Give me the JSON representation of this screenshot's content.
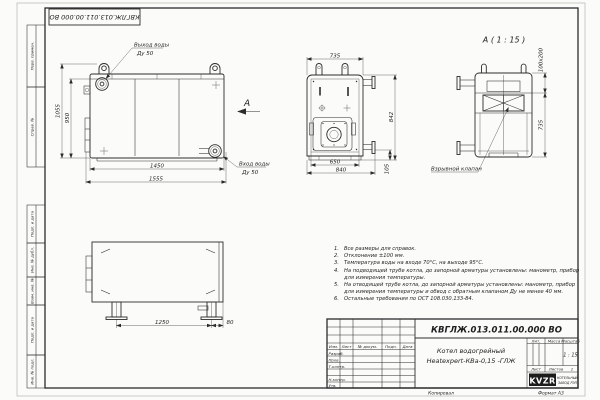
{
  "sheet": {
    "top_stamp": "КВГЛЖ.013.011.00.000 ВО",
    "margin_strips": {
      "s1": "Перв. примен.",
      "s2": "Справ. №",
      "s3": "Подп. и дата",
      "s4": "Инв. № дубл.",
      "s5": "Взам. инв. №",
      "s6": "Подп. и дата",
      "s7": "Инв. № подл."
    },
    "footer": {
      "copied": "Копировал",
      "format": "Формат А3"
    }
  },
  "side_view": {
    "outlet_label": "Выход воды",
    "outlet_dn": "Ду 50",
    "inlet_label": "Вход воды",
    "inlet_dn": "Ду 50",
    "view_letter": "А",
    "dims": {
      "height_overall": "1055",
      "height_body": "950",
      "width_inner": "1450",
      "width_overall": "1555"
    }
  },
  "front_view": {
    "dims": {
      "top_width": "735",
      "inner_width": "650",
      "overall_width": "840",
      "height": "842",
      "stub_height": "105"
    }
  },
  "detail_view": {
    "title": "А ( 1 : 15 )",
    "valve_label": "Взрывной клапан",
    "dims": {
      "slot": "100х200",
      "height": "735"
    }
  },
  "rear_view": {
    "dims": {
      "leg_span": "1250",
      "edge_offset": "80"
    }
  },
  "notes": [
    {
      "num": "1.",
      "text": "Все размеры для справок."
    },
    {
      "num": "2.",
      "text": "Отклонение ±100 мм."
    },
    {
      "num": "3.",
      "text": "Температура воды на входе 70°С, на выходе 95°С."
    },
    {
      "num": "4.",
      "text": "На подводящей трубе котла, до запорной арматуры установлены: манометр, прибор для измерения температуры."
    },
    {
      "num": "5.",
      "text": "На отводящей трубе котла, до запорной арматуры установлены: манометр, прибор для измерения температуры и обвод с обратным клапаном Ду не менее 40 мм."
    },
    {
      "num": "6.",
      "text": "Остальные требования по ОСТ 108.030.133-84."
    }
  ],
  "title_block": {
    "doc_number": "КВГЛЖ.013.011.00.000 ВО",
    "name_line1": "Котел водогрейный",
    "name_line2": "Heatexpert-КВа-0,15 -ГЛЖ",
    "col_izm": "Изм.",
    "col_list": "Лист",
    "col_doc": "№ докум.",
    "col_podp": "Подп.",
    "col_data": "Дата",
    "row_razrab": "Разраб.",
    "row_prov": "Пров.",
    "row_tkontr": "Т.контр.",
    "row_nkontr": "Н.контр.",
    "row_utv": "Утв.",
    "hdr_lit": "Лит.",
    "hdr_mass": "Масса",
    "hdr_scale": "Масштаб",
    "scale_value": "1 : 15",
    "sheet_label": "Лист",
    "sheets_label": "Листов",
    "sheets_value": "1",
    "logo_text": "KVZR",
    "logo_caption1": "КОТЕЛЬНЫЙ",
    "logo_caption2": "ЗАВОД РЭП"
  }
}
